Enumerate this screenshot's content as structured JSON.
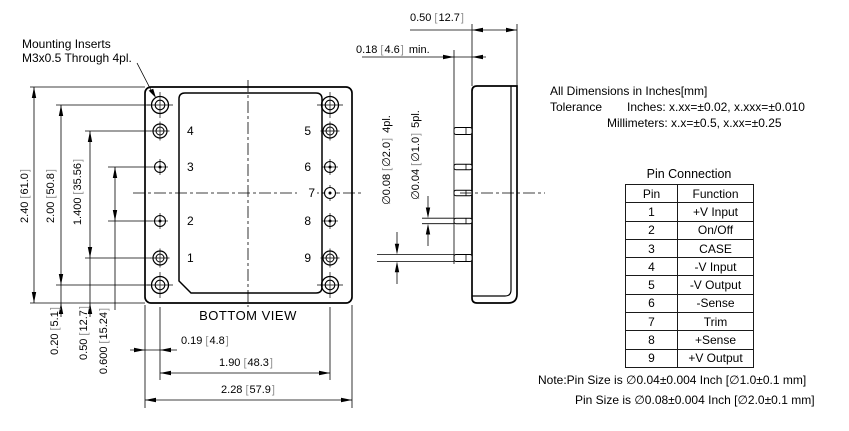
{
  "drawing": {
    "mounting_note": {
      "line1": "Mounting Inserts",
      "line2": "M3x0.5 Through 4pl."
    },
    "views": {
      "bottom": {
        "label": "BOTTOM VIEW"
      }
    },
    "pins_left": [
      "4",
      "3",
      "2",
      "1"
    ],
    "pins_right": [
      "5",
      "6",
      "7",
      "8",
      "9"
    ],
    "dims": {
      "height_overall": {
        "in": "2.40",
        "mm": "61.0"
      },
      "height_inserts": {
        "in": "2.00",
        "mm": "50.8"
      },
      "height_pins_outer": {
        "in": "1.400",
        "mm": "35.56"
      },
      "height_pins_inner": {
        "in": "0.600",
        "mm": "15.24"
      },
      "bottom_to_insert": {
        "in": "0.20",
        "mm": "5.1"
      },
      "bottom_to_pin": {
        "in": "0.50",
        "mm": "12.7"
      },
      "edge_to_pin": {
        "in": "0.19",
        "mm": "4.8"
      },
      "pin_span": {
        "in": "1.90",
        "mm": "48.3"
      },
      "width_overall": {
        "in": "2.28",
        "mm": "57.9"
      },
      "case_depth": {
        "in": "0.50",
        "mm": "12.7"
      },
      "pin_length": {
        "in": "0.18",
        "mm": "4.6",
        "suffix": "min."
      },
      "pin_dia_small": {
        "in": "∅0.04",
        "mm": "∅1.0",
        "suffix": "5pl."
      },
      "pin_dia_large": {
        "in": "∅0.08",
        "mm": "∅2.0",
        "suffix": "4pl."
      }
    }
  },
  "tolerance_block": {
    "line1": "All Dimensions in Inches[mm]",
    "label": "Tolerance",
    "inches": "Inches: x.xx=±0.02, x.xxx=±0.010",
    "millimeters": "Millimeters: x.x=±0.5, x.xx=±0.25"
  },
  "pin_table": {
    "title": "Pin Connection",
    "headers": [
      "Pin",
      "Function"
    ],
    "rows": [
      [
        "1",
        "+V Input"
      ],
      [
        "2",
        "On/Off"
      ],
      [
        "3",
        "CASE"
      ],
      [
        "4",
        "-V Input"
      ],
      [
        "5",
        "-V Output"
      ],
      [
        "6",
        "-Sense"
      ],
      [
        "7",
        "Trim"
      ],
      [
        "8",
        "+Sense"
      ],
      [
        "9",
        "+V Output"
      ]
    ]
  },
  "notes": {
    "line1": "Note:Pin Size is ∅0.04±0.004 Inch [∅1.0±0.1 mm]",
    "line2": "Pin Size is ∅0.08±0.004 Inch [∅2.0±0.1 mm]"
  }
}
